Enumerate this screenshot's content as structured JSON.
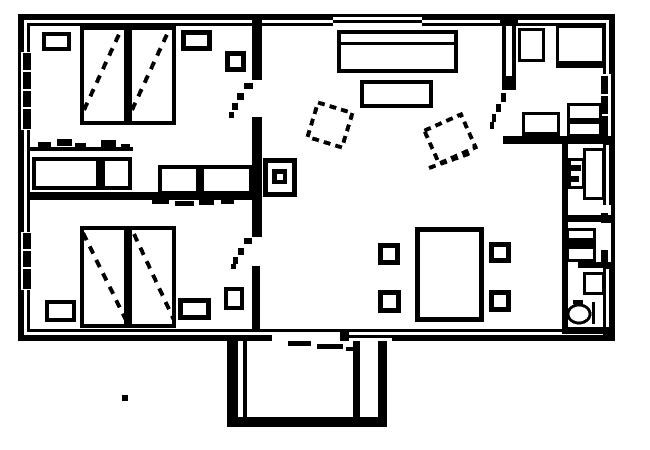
{
  "meta": {
    "canvas": {
      "width": 650,
      "height": 450
    },
    "background_color": "#ffffff",
    "ink_color": "#000000"
  },
  "plan": {
    "elements": [
      {
        "name": "wall-inner-frame",
        "type": "outline",
        "x": 27,
        "y": 23,
        "w": 579,
        "h": 309,
        "sw": 3
      },
      {
        "name": "wall-outer-frame",
        "type": "outline",
        "x": 18,
        "y": 14,
        "w": 597,
        "h": 327,
        "sw": 6
      },
      {
        "name": "window-top-living-punch",
        "type": "rect",
        "x": 333,
        "y": 17,
        "w": 89,
        "h": 14,
        "white": true
      },
      {
        "name": "window-top-living-line",
        "type": "rect",
        "x": 333,
        "y": 20,
        "w": 89,
        "h": 3
      },
      {
        "name": "window-left-upper-punch",
        "type": "rect",
        "x": 21,
        "y": 52,
        "w": 10,
        "h": 78,
        "white": true
      },
      {
        "name": "window-left-upper-mullion-1",
        "type": "rect",
        "x": 23,
        "y": 53,
        "w": 8,
        "h": 17
      },
      {
        "name": "window-left-upper-mullion-2",
        "type": "rect",
        "x": 23,
        "y": 72,
        "w": 8,
        "h": 17
      },
      {
        "name": "window-left-upper-mullion-3",
        "type": "rect",
        "x": 23,
        "y": 91,
        "w": 8,
        "h": 16
      },
      {
        "name": "window-left-upper-mullion-4",
        "type": "rect",
        "x": 23,
        "y": 109,
        "w": 8,
        "h": 20
      },
      {
        "name": "window-left-lower-punch",
        "type": "rect",
        "x": 21,
        "y": 232,
        "w": 10,
        "h": 58,
        "white": true
      },
      {
        "name": "window-left-lower-mullion-1",
        "type": "rect",
        "x": 23,
        "y": 233,
        "w": 8,
        "h": 16
      },
      {
        "name": "window-left-lower-mullion-2",
        "type": "rect",
        "x": 23,
        "y": 251,
        "w": 8,
        "h": 16
      },
      {
        "name": "window-left-lower-mullion-3",
        "type": "rect",
        "x": 23,
        "y": 269,
        "w": 8,
        "h": 20
      },
      {
        "name": "window-right-kitchen-punch",
        "type": "rect",
        "x": 601,
        "y": 74,
        "w": 14,
        "h": 64,
        "white": true
      },
      {
        "name": "window-right-kitchen-outer-line",
        "type": "rect",
        "x": 611,
        "y": 74,
        "w": 4,
        "h": 64
      },
      {
        "name": "window-right-kitchen-mullion-1",
        "type": "rect",
        "x": 601,
        "y": 76,
        "w": 7,
        "h": 18
      },
      {
        "name": "window-right-kitchen-mullion-2",
        "type": "rect",
        "x": 601,
        "y": 96,
        "w": 7,
        "h": 18
      },
      {
        "name": "window-right-kitchen-mullion-3",
        "type": "rect",
        "x": 601,
        "y": 116,
        "w": 7,
        "h": 20
      },
      {
        "name": "window-right-bath-punch",
        "type": "rect",
        "x": 601,
        "y": 205,
        "w": 14,
        "h": 63,
        "white": true
      },
      {
        "name": "window-right-bath-outer-line",
        "type": "rect",
        "x": 611,
        "y": 205,
        "w": 4,
        "h": 63
      },
      {
        "name": "window-right-bath-mullion-1",
        "type": "rect",
        "x": 601,
        "y": 213,
        "w": 7,
        "h": 10
      },
      {
        "name": "window-right-bath-mullion-2",
        "type": "rect",
        "x": 601,
        "y": 250,
        "w": 7,
        "h": 14
      },
      {
        "name": "porch-door-punch",
        "type": "rect",
        "x": 272,
        "y": 332,
        "w": 68,
        "h": 10,
        "white": true
      },
      {
        "name": "window-bottom-punch",
        "type": "rect",
        "x": 348,
        "y": 332,
        "w": 44,
        "h": 10,
        "white": true
      },
      {
        "name": "window-bottom-line",
        "type": "rect",
        "x": 348,
        "y": 335,
        "w": 44,
        "h": 3
      },
      {
        "name": "porch-door-post",
        "type": "rect",
        "x": 340,
        "y": 329,
        "w": 9,
        "h": 12
      },
      {
        "name": "partition-wall-top-junction",
        "type": "rect",
        "x": 252,
        "y": 16,
        "w": 10,
        "h": 8
      },
      {
        "name": "partition-wall-upper",
        "type": "rect",
        "x": 252,
        "y": 23,
        "w": 10,
        "h": 57
      },
      {
        "name": "partition-wall-mid",
        "type": "rect",
        "x": 252,
        "y": 117,
        "w": 10,
        "h": 120
      },
      {
        "name": "partition-wall-lower",
        "type": "rect",
        "x": 252,
        "y": 266,
        "w": 8,
        "h": 66
      },
      {
        "name": "bedroom-divider-wall",
        "type": "rect",
        "x": 27,
        "y": 192,
        "w": 226,
        "h": 8
      },
      {
        "name": "kitchen-wall-top-junction",
        "type": "rect",
        "x": 500,
        "y": 14,
        "w": 18,
        "h": 10
      },
      {
        "name": "kitchen-wall-outer-line",
        "type": "rect",
        "x": 502,
        "y": 24,
        "w": 4,
        "h": 52
      },
      {
        "name": "kitchen-wall-inner-line",
        "type": "rect",
        "x": 512,
        "y": 24,
        "w": 4,
        "h": 52
      },
      {
        "name": "kitchen-wall-end-block",
        "type": "rect",
        "x": 502,
        "y": 76,
        "w": 14,
        "h": 14
      },
      {
        "name": "kitchen-bottom-wall",
        "type": "rect",
        "x": 503,
        "y": 136,
        "w": 103,
        "h": 8
      },
      {
        "name": "kitchen-bottom-wall-junction",
        "type": "rect",
        "x": 603,
        "y": 136,
        "w": 12,
        "h": 9
      },
      {
        "name": "bath-left-wall",
        "type": "rect",
        "x": 562,
        "y": 144,
        "w": 6,
        "h": 190
      },
      {
        "name": "bath-divider-upper",
        "type": "rect",
        "x": 562,
        "y": 215,
        "w": 49,
        "h": 7
      },
      {
        "name": "bath-divider-upper-junction",
        "type": "rect",
        "x": 603,
        "y": 215,
        "w": 12,
        "h": 8
      },
      {
        "name": "bath-divider-lower",
        "type": "rect",
        "x": 578,
        "y": 262,
        "w": 33,
        "h": 6
      },
      {
        "name": "bath-divider-lower-junction",
        "type": "rect",
        "x": 603,
        "y": 262,
        "w": 12,
        "h": 7
      },
      {
        "name": "bath-bottom-wall",
        "type": "rect",
        "x": 562,
        "y": 327,
        "w": 44,
        "h": 7
      },
      {
        "name": "bath-bottom-wall-junction",
        "type": "rect",
        "x": 603,
        "y": 327,
        "w": 12,
        "h": 8
      },
      {
        "name": "closet-top-line",
        "type": "rect",
        "x": 28,
        "y": 147,
        "w": 105,
        "h": 4
      },
      {
        "name": "closet-left",
        "type": "outline",
        "x": 32,
        "y": 157,
        "w": 100,
        "h": 33,
        "sw": 4
      },
      {
        "name": "closet-left-divider",
        "type": "rect",
        "x": 96,
        "y": 157,
        "w": 9,
        "h": 33
      },
      {
        "name": "closet-right",
        "type": "outline",
        "x": 158,
        "y": 165,
        "w": 95,
        "h": 30,
        "sw": 4
      },
      {
        "name": "closet-right-divider",
        "type": "rect",
        "x": 196,
        "y": 165,
        "w": 8,
        "h": 30
      },
      {
        "name": "closet-hanger-mark-1",
        "type": "rect",
        "x": 38,
        "y": 142,
        "w": 13,
        "h": 6
      },
      {
        "name": "closet-hanger-mark-2",
        "type": "rect",
        "x": 57,
        "y": 139,
        "w": 15,
        "h": 7
      },
      {
        "name": "closet-hanger-mark-3",
        "type": "rect",
        "x": 75,
        "y": 143,
        "w": 11,
        "h": 6
      },
      {
        "name": "closet-hanger-mark-4",
        "type": "rect",
        "x": 101,
        "y": 140,
        "w": 15,
        "h": 7
      },
      {
        "name": "closet-hanger-mark-5",
        "type": "rect",
        "x": 121,
        "y": 144,
        "w": 9,
        "h": 6
      },
      {
        "name": "closet-dash-1",
        "type": "rect",
        "x": 152,
        "y": 199,
        "w": 17,
        "h": 5
      },
      {
        "name": "closet-dash-2",
        "type": "rect",
        "x": 175,
        "y": 201,
        "w": 19,
        "h": 5
      },
      {
        "name": "closet-dash-3",
        "type": "rect",
        "x": 199,
        "y": 200,
        "w": 15,
        "h": 5
      },
      {
        "name": "closet-dash-4",
        "type": "rect",
        "x": 221,
        "y": 199,
        "w": 13,
        "h": 5
      },
      {
        "name": "bed-1",
        "type": "outline",
        "x": 80,
        "y": 26,
        "w": 48,
        "h": 99,
        "sw": 4
      },
      {
        "name": "bed-2",
        "type": "outline",
        "x": 128,
        "y": 26,
        "w": 48,
        "h": 99,
        "sw": 4
      },
      {
        "name": "bed-1-diagonal",
        "type": "line",
        "x": 84,
        "y": 110,
        "x2": 121,
        "y2": 30,
        "sw": 4,
        "dash": "8,7"
      },
      {
        "name": "bed-2-diagonal",
        "type": "line",
        "x": 132,
        "y": 110,
        "x2": 169,
        "y2": 30,
        "sw": 4,
        "dash": "8,7"
      },
      {
        "name": "nightstand-upper-left",
        "type": "outline",
        "x": 42,
        "y": 32,
        "w": 29,
        "h": 19,
        "sw": 4
      },
      {
        "name": "nightstand-upper-right",
        "type": "outline",
        "x": 181,
        "y": 30,
        "w": 31,
        "h": 21,
        "sw": 5
      },
      {
        "name": "side-table-upper",
        "type": "outline",
        "x": 225,
        "y": 51,
        "w": 21,
        "h": 21,
        "sw": 5
      },
      {
        "name": "bed-3",
        "type": "outline",
        "x": 80,
        "y": 226,
        "w": 48,
        "h": 102,
        "sw": 4
      },
      {
        "name": "bed-4",
        "type": "outline",
        "x": 128,
        "y": 226,
        "w": 48,
        "h": 102,
        "sw": 4
      },
      {
        "name": "bed-3-diagonal",
        "type": "line",
        "x": 83,
        "y": 233,
        "x2": 127,
        "y2": 322,
        "sw": 4,
        "dash": "8,7"
      },
      {
        "name": "bed-4-diagonal",
        "type": "line",
        "x": 134,
        "y": 234,
        "x2": 174,
        "y2": 320,
        "sw": 4,
        "dash": "8,7"
      },
      {
        "name": "nightstand-lower-left",
        "type": "outline",
        "x": 45,
        "y": 300,
        "w": 31,
        "h": 22,
        "sw": 4
      },
      {
        "name": "nightstand-lower-right",
        "type": "outline",
        "x": 178,
        "y": 298,
        "w": 33,
        "h": 22,
        "sw": 5
      },
      {
        "name": "side-table-lower",
        "type": "outline",
        "x": 224,
        "y": 287,
        "w": 20,
        "h": 23,
        "sw": 4
      },
      {
        "name": "sofa",
        "type": "outline",
        "x": 337,
        "y": 30,
        "w": 121,
        "h": 43,
        "sw": 4
      },
      {
        "name": "sofa-back-line",
        "type": "rect",
        "x": 341,
        "y": 42,
        "w": 113,
        "h": 3
      },
      {
        "name": "coffee-table",
        "type": "outline",
        "x": 360,
        "y": 80,
        "w": 73,
        "h": 28,
        "sw": 4
      },
      {
        "name": "armchair-left",
        "type": "outline",
        "x": 310,
        "y": 105,
        "w": 40,
        "h": 40,
        "sw": 4,
        "dash": "7,5",
        "rot": 17
      },
      {
        "name": "armchair-right",
        "type": "outline",
        "x": 428,
        "y": 119,
        "w": 44,
        "h": 40,
        "sw": 4,
        "dash": "7,5",
        "rot": -24
      },
      {
        "name": "armchair-right-seat-line",
        "type": "line",
        "x": 429,
        "y": 168,
        "x2": 471,
        "y2": 153,
        "sw": 4,
        "dash": "7,5"
      },
      {
        "name": "stove-fireplace",
        "type": "outline",
        "x": 263,
        "y": 158,
        "w": 34,
        "h": 39,
        "sw": 5
      },
      {
        "name": "stove-fireplace-core",
        "type": "rect",
        "x": 272,
        "y": 169,
        "w": 15,
        "h": 15
      },
      {
        "name": "stove-fireplace-core-hole",
        "type": "rect",
        "x": 277,
        "y": 174,
        "w": 6,
        "h": 6,
        "white": true
      },
      {
        "name": "dining-table",
        "type": "outline",
        "x": 415,
        "y": 227,
        "w": 69,
        "h": 95,
        "sw": 5
      },
      {
        "name": "dining-chair-top-left",
        "type": "outline",
        "x": 378,
        "y": 243,
        "w": 22,
        "h": 22,
        "sw": 5
      },
      {
        "name": "dining-chair-bottom-left",
        "type": "outline",
        "x": 378,
        "y": 290,
        "w": 23,
        "h": 23,
        "sw": 5
      },
      {
        "name": "dining-chair-top-right",
        "type": "outline",
        "x": 489,
        "y": 242,
        "w": 22,
        "h": 21,
        "sw": 5
      },
      {
        "name": "dining-chair-bottom-right",
        "type": "outline",
        "x": 489,
        "y": 290,
        "w": 22,
        "h": 22,
        "sw": 5
      },
      {
        "name": "kitchen-table",
        "type": "outline",
        "x": 518,
        "y": 28,
        "w": 27,
        "h": 34,
        "sw": 3
      },
      {
        "name": "kitchen-counter",
        "type": "outline",
        "x": 556,
        "y": 25,
        "w": 49,
        "h": 43,
        "sw": 3
      },
      {
        "name": "kitchen-counter-front",
        "type": "rect",
        "x": 556,
        "y": 61,
        "w": 49,
        "h": 7
      },
      {
        "name": "kitchen-stove",
        "type": "outline",
        "x": 522,
        "y": 112,
        "w": 38,
        "h": 26,
        "sw": 3
      },
      {
        "name": "kitchen-stove-front",
        "type": "rect",
        "x": 522,
        "y": 132,
        "w": 38,
        "h": 6
      },
      {
        "name": "kitchen-sink",
        "type": "outline",
        "x": 567,
        "y": 103,
        "w": 35,
        "h": 34,
        "sw": 3
      },
      {
        "name": "kitchen-sink-divider",
        "type": "rect",
        "x": 567,
        "y": 118,
        "w": 35,
        "h": 6
      },
      {
        "name": "bath-boiler",
        "type": "outline",
        "x": 568,
        "y": 158,
        "w": 17,
        "h": 31,
        "sw": 3
      },
      {
        "name": "bath-boiler-mark-1",
        "type": "rect",
        "x": 570,
        "y": 165,
        "w": 11,
        "h": 6
      },
      {
        "name": "bath-boiler-mark-2",
        "type": "rect",
        "x": 570,
        "y": 176,
        "w": 9,
        "h": 6
      },
      {
        "name": "bath-shower",
        "type": "outline",
        "x": 583,
        "y": 148,
        "w": 22,
        "h": 52,
        "sw": 3
      },
      {
        "name": "bath-vanity",
        "type": "outline",
        "x": 566,
        "y": 228,
        "w": 30,
        "h": 34,
        "sw": 3
      },
      {
        "name": "bath-vanity-band",
        "type": "rect",
        "x": 566,
        "y": 238,
        "w": 30,
        "h": 11
      },
      {
        "name": "bath-cabinet",
        "type": "outline",
        "x": 583,
        "y": 272,
        "w": 22,
        "h": 23,
        "sw": 3
      },
      {
        "name": "toilet-bowl",
        "type": "ellipse",
        "x": 579,
        "y": 314,
        "w": 11,
        "h": 9,
        "sw": 3
      },
      {
        "name": "toilet-tank-line",
        "type": "rect",
        "x": 592,
        "y": 302,
        "w": 3,
        "h": 22
      },
      {
        "name": "toilet-mark",
        "type": "rect",
        "x": 573,
        "y": 300,
        "w": 10,
        "h": 4
      },
      {
        "name": "porch-left-outer-wall",
        "type": "rect",
        "x": 227,
        "y": 341,
        "w": 11,
        "h": 86
      },
      {
        "name": "porch-left-inner-wall",
        "type": "rect",
        "x": 243,
        "y": 341,
        "w": 4,
        "h": 76
      },
      {
        "name": "porch-right-inner-wall",
        "type": "rect",
        "x": 353,
        "y": 341,
        "w": 7,
        "h": 76
      },
      {
        "name": "porch-right-outer-wall",
        "type": "rect",
        "x": 378,
        "y": 341,
        "w": 9,
        "h": 86
      },
      {
        "name": "porch-bottom-wall",
        "type": "rect",
        "x": 227,
        "y": 417,
        "w": 160,
        "h": 10
      },
      {
        "name": "porch-door-dash-1",
        "type": "rect",
        "x": 288,
        "y": 341,
        "w": 23,
        "h": 5
      },
      {
        "name": "porch-door-dash-2",
        "type": "rect",
        "x": 317,
        "y": 344,
        "w": 26,
        "h": 5
      },
      {
        "name": "porch-door-dash-3",
        "type": "rect",
        "x": 346,
        "y": 347,
        "w": 11,
        "h": 4
      },
      {
        "name": "bedroom1-door-swing-dash-1",
        "type": "rect",
        "x": 244,
        "y": 83,
        "w": 9,
        "h": 6
      },
      {
        "name": "bedroom1-door-swing-dash-2",
        "type": "rect",
        "x": 237,
        "y": 93,
        "w": 7,
        "h": 7
      },
      {
        "name": "bedroom1-door-swing-dash-3",
        "type": "rect",
        "x": 232,
        "y": 103,
        "w": 6,
        "h": 7
      },
      {
        "name": "bedroom1-door-swing-dash-4",
        "type": "rect",
        "x": 229,
        "y": 112,
        "w": 5,
        "h": 6
      },
      {
        "name": "bedroom2-door-swing-dash-1",
        "type": "rect",
        "x": 244,
        "y": 238,
        "w": 8,
        "h": 6
      },
      {
        "name": "bedroom2-door-swing-dash-2",
        "type": "rect",
        "x": 238,
        "y": 248,
        "w": 6,
        "h": 7
      },
      {
        "name": "bedroom2-door-swing-dash-3",
        "type": "rect",
        "x": 233,
        "y": 257,
        "w": 5,
        "h": 7
      },
      {
        "name": "bedroom2-door-swing-dash-4",
        "type": "rect",
        "x": 231,
        "y": 264,
        "w": 5,
        "h": 5
      },
      {
        "name": "kitchen-door-swing-dash-1",
        "type": "rect",
        "x": 501,
        "y": 93,
        "w": 5,
        "h": 9
      },
      {
        "name": "kitchen-door-swing-dash-2",
        "type": "rect",
        "x": 496,
        "y": 104,
        "w": 5,
        "h": 8
      },
      {
        "name": "kitchen-door-swing-dash-3",
        "type": "rect",
        "x": 492,
        "y": 114,
        "w": 4,
        "h": 8
      },
      {
        "name": "kitchen-door-swing-dash-4",
        "type": "rect",
        "x": 490,
        "y": 122,
        "w": 4,
        "h": 7
      },
      {
        "name": "stray-dot",
        "type": "rect",
        "x": 122,
        "y": 395,
        "w": 6,
        "h": 6
      }
    ]
  }
}
